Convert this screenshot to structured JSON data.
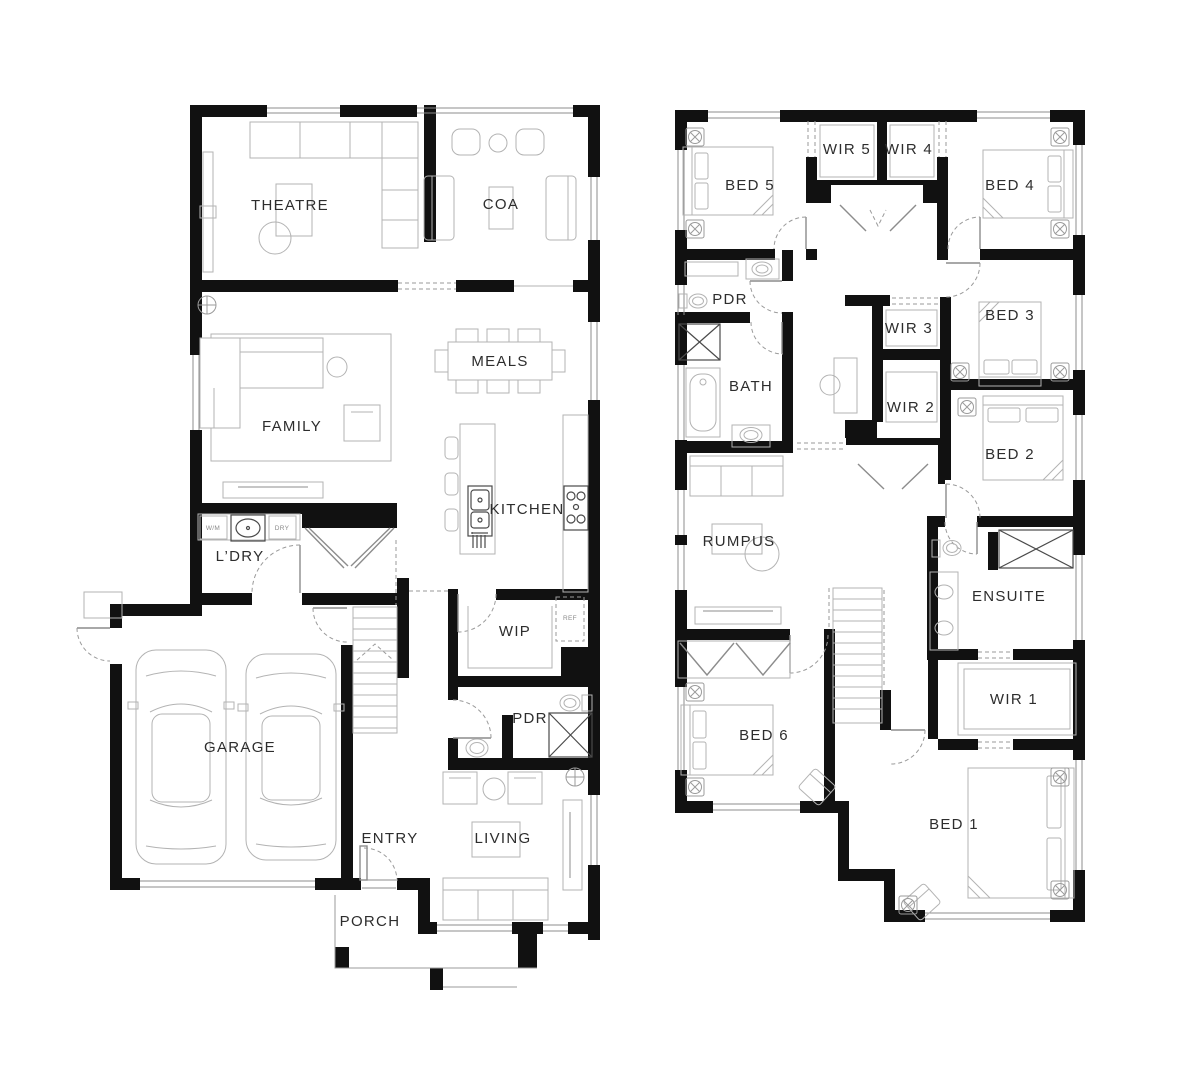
{
  "colors": {
    "background": "#ffffff",
    "wall": "#111111",
    "furniture_line": "#b3b3b3",
    "door_line": "#8c8c8c",
    "dashed_line": "#9a9a9a",
    "label": "#2d2d2d",
    "small_label": "#8a8a8a"
  },
  "ground_floor": {
    "rooms": {
      "theatre": "THEATRE",
      "coach": "COA",
      "meals": "MEALS",
      "family": "FAMILY",
      "kitchen": "KITCHEN",
      "laundry": "L’DRY",
      "wip": "WIP",
      "powder": "PDR",
      "garage": "GARAGE",
      "entry": "ENTRY",
      "living": "LIVING",
      "porch": "PORCH"
    },
    "appliances": {
      "washer": "W/M",
      "dryer": "DRY",
      "fridge": "REF"
    }
  },
  "first_floor": {
    "rooms": {
      "bed5": "BED 5",
      "wir5": "WIR 5",
      "wir4": "WIR 4",
      "bed4": "BED 4",
      "powder": "PDR",
      "bath": "BATH",
      "wir3": "WIR 3",
      "bed3": "BED 3",
      "wir2": "WIR 2",
      "bed2": "BED 2",
      "rumpus": "RUMPUS",
      "ensuite": "ENSUITE",
      "wir1": "WIR 1",
      "bed6": "BED 6",
      "bed1": "BED 1"
    }
  }
}
